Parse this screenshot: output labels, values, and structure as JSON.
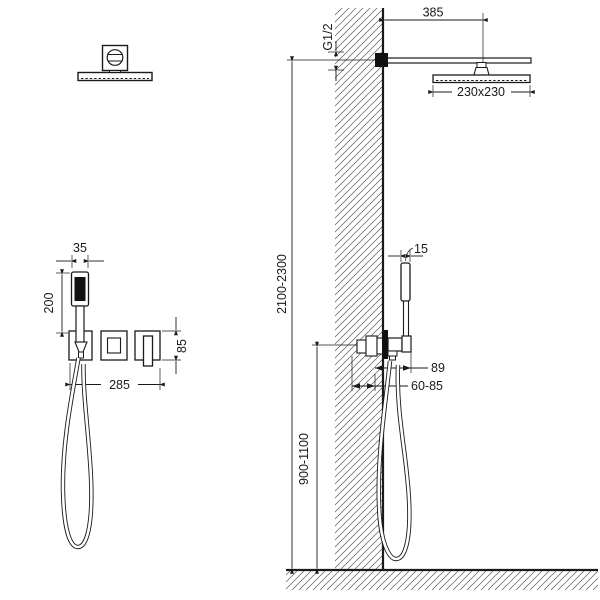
{
  "diagram": {
    "title": "shower-system-installation-drawing",
    "dims": {
      "arm_length": "385",
      "thread": "G1/2",
      "head_size": "230x230",
      "height_overall": "2100-2300",
      "handshower_side_width": "15",
      "projection": "89",
      "embed_depth": "60-85",
      "mixer_height": "900-1100",
      "handshower_width": "35",
      "handshower_length": "200",
      "trim_height": "85",
      "trim_width": "285"
    }
  }
}
